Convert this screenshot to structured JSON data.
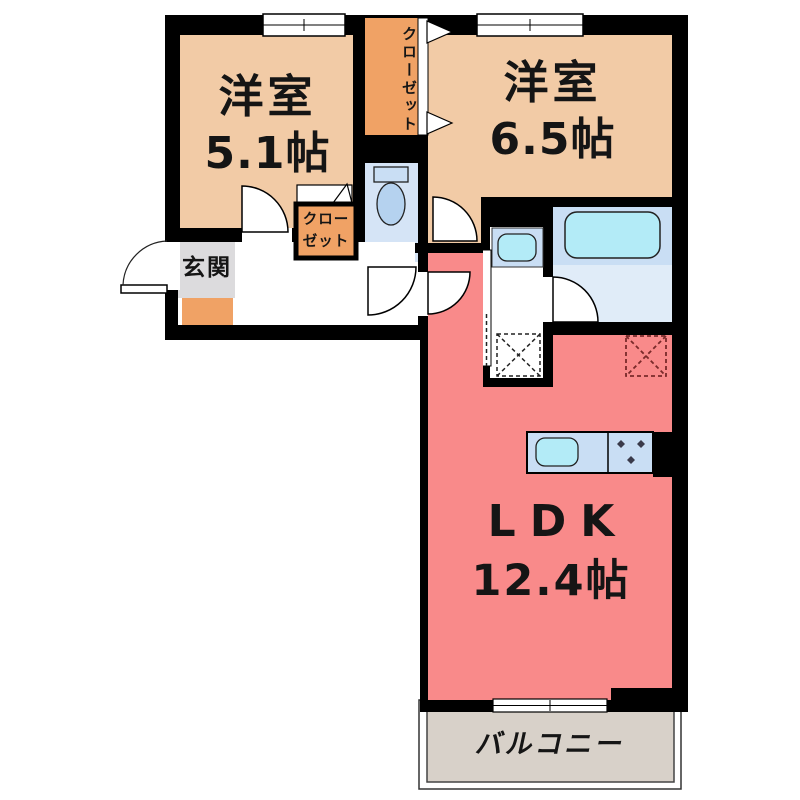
{
  "floorplan": {
    "type": "apartment-floor-plan",
    "rooms": {
      "western_room_small": {
        "name": "洋室",
        "size": "5.1帖"
      },
      "western_room_large": {
        "name": "洋室",
        "size": "6.5帖"
      },
      "ldk": {
        "name": "LDK",
        "size": "12.4帖"
      },
      "entrance": {
        "label": "玄関"
      },
      "closet_tall": {
        "label": "クローゼット"
      },
      "closet_small": {
        "label_line1": "クロー",
        "label_line2": "ゼット"
      },
      "balcony": {
        "label": "バルコニー"
      }
    },
    "icons": {
      "toilet": "toilet-icon",
      "bathtub": "bathtub-icon",
      "washbasin": "washbasin-icon",
      "kitchen_sink": "kitchen-sink-icon",
      "stove": "stove-burner-icon",
      "washing_machine_space": "washing-machine-space-icon",
      "refrigerator_space": "refrigerator-space-icon",
      "door_swing": "door-swing-arc-icon",
      "closet_fold_door": "folding-door-triangle-icon",
      "window": "window-icon",
      "sliding_window": "sliding-window-icon"
    },
    "colors": {
      "room_floor": "#f2cba6",
      "closet": "#f0a265",
      "ldk_floor": "#f98a8a",
      "entrance_floor": "#dcdbdd",
      "entrance_step": "#f0a265",
      "toilet_floor": "#d5e4f6",
      "bath_upper": "#c9def4",
      "bath_lower": "#e0ecf8",
      "fixture_blue": "#c9def4",
      "fixture_ellipse": "#b5d2ef",
      "sink_cyan": "#b3ebf7",
      "balcony_floor": "#d8d1c9",
      "wall": "#000000"
    }
  }
}
